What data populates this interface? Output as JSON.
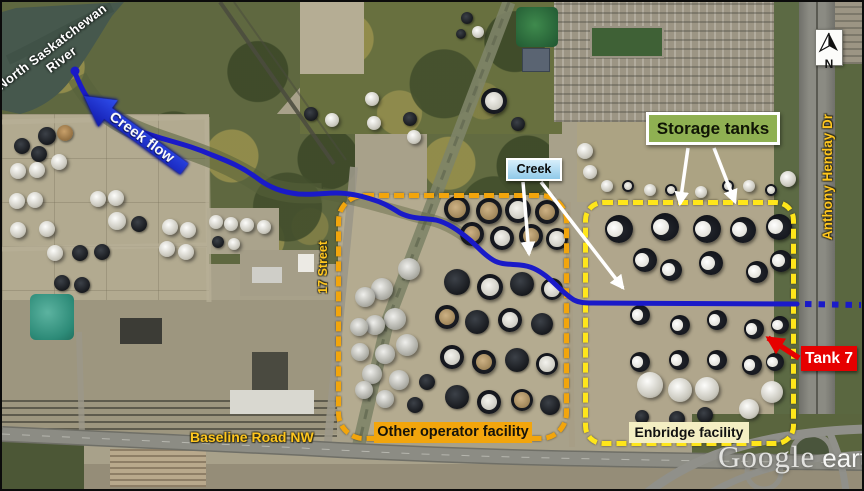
{
  "annotations": {
    "river": {
      "line1": "North Saskatchewan",
      "line2": "River"
    },
    "creek_flow": "Creek flow",
    "creek": "Creek",
    "storage_tanks": "Storage tanks",
    "street_17": "17 Street",
    "anthony_henday": "Anthony Henday Dr",
    "baseline_road": "Baseline Road NW",
    "other_facility": "Other operator facility",
    "enbridge_facility": "Enbridge facility",
    "tank7": "Tank 7",
    "north": "N"
  },
  "watermark": {
    "brand": "Google",
    "product": "earth"
  },
  "colors": {
    "creek": "#1a1ac8",
    "box-other": "#f2a50c",
    "box-enbridge": "#ffe61a",
    "road-label": "#ffc61e",
    "tank7-bg": "#e60000",
    "storage-bg": "#8fb052",
    "creek-label-top": "#d8effb",
    "creek-label-bottom": "#8fc9e9",
    "enbridge-label-bg": "#f4efc3"
  },
  "map_features": {
    "creek_path": "M73,71 C80,88 86,99 96,108 C108,119 122,123 140,130 C165,139 185,142 210,153 C228,160 240,165 255,176 C268,186 280,190 296,192 C312,193 322,191 334,191 C348,191 360,194 372,198 C382,201 390,206 398,211 C410,217 422,216 434,218 C446,221 456,228 468,238 C477,246 481,252 491,258 C499,263 509,262 518,263 C529,264 536,268 544,274 C553,281 561,291 572,298 C578,301 584,301 590,301 L795,302",
    "creek_outflow_dotted": "M803,302 L859,303",
    "tanks": [
      [
        45,
        134,
        9,
        "d"
      ],
      [
        63,
        131,
        8,
        "b"
      ],
      [
        20,
        144,
        8,
        "d"
      ],
      [
        37,
        152,
        8,
        "d"
      ],
      [
        57,
        160,
        8,
        "w"
      ],
      [
        16,
        169,
        8,
        "w"
      ],
      [
        35,
        168,
        8,
        "w"
      ],
      [
        15,
        199,
        8,
        "w"
      ],
      [
        33,
        198,
        8,
        "w"
      ],
      [
        96,
        197,
        8,
        "w"
      ],
      [
        114,
        196,
        8,
        "w"
      ],
      [
        16,
        228,
        8,
        "w"
      ],
      [
        45,
        227,
        8,
        "w"
      ],
      [
        115,
        219,
        9,
        "w"
      ],
      [
        137,
        222,
        8,
        "d"
      ],
      [
        168,
        225,
        8,
        "w"
      ],
      [
        186,
        228,
        8,
        "w"
      ],
      [
        165,
        247,
        8,
        "w"
      ],
      [
        184,
        250,
        8,
        "w"
      ],
      [
        53,
        251,
        8,
        "w"
      ],
      [
        78,
        251,
        8,
        "d"
      ],
      [
        60,
        281,
        8,
        "d"
      ],
      [
        80,
        283,
        8,
        "d"
      ],
      [
        100,
        250,
        8,
        "d"
      ],
      [
        214,
        220,
        7,
        "w"
      ],
      [
        229,
        222,
        7,
        "w"
      ],
      [
        245,
        223,
        7,
        "w"
      ],
      [
        262,
        225,
        7,
        "w"
      ],
      [
        216,
        240,
        6,
        "d"
      ],
      [
        232,
        242,
        6,
        "w"
      ],
      [
        370,
        97,
        7,
        "w"
      ],
      [
        372,
        121,
        7,
        "w"
      ],
      [
        309,
        112,
        7,
        "d"
      ],
      [
        330,
        118,
        7,
        "w"
      ],
      [
        412,
        135,
        7,
        "w"
      ],
      [
        408,
        117,
        7,
        "d"
      ],
      [
        465,
        16,
        6,
        "d"
      ],
      [
        476,
        30,
        6,
        "w"
      ],
      [
        459,
        32,
        5,
        "d"
      ],
      [
        492,
        99,
        13,
        "c"
      ],
      [
        516,
        122,
        7,
        "d"
      ],
      [
        583,
        149,
        8,
        "w"
      ],
      [
        588,
        170,
        7,
        "w"
      ],
      [
        605,
        184,
        6,
        "w"
      ],
      [
        626,
        184,
        6,
        "c"
      ],
      [
        648,
        188,
        6,
        "w"
      ],
      [
        669,
        188,
        6,
        "c"
      ],
      [
        699,
        190,
        6,
        "w"
      ],
      [
        726,
        184,
        6,
        "c"
      ],
      [
        747,
        184,
        6,
        "w"
      ],
      [
        769,
        188,
        6,
        "c"
      ],
      [
        786,
        177,
        8,
        "w"
      ],
      [
        617,
        227,
        14,
        "e"
      ],
      [
        663,
        225,
        14,
        "e"
      ],
      [
        705,
        227,
        14,
        "e"
      ],
      [
        741,
        228,
        13,
        "e"
      ],
      [
        777,
        225,
        13,
        "e"
      ],
      [
        643,
        258,
        12,
        "e"
      ],
      [
        669,
        268,
        11,
        "e"
      ],
      [
        709,
        261,
        12,
        "e"
      ],
      [
        755,
        270,
        11,
        "e"
      ],
      [
        779,
        259,
        11,
        "e"
      ],
      [
        638,
        313,
        10,
        "e"
      ],
      [
        678,
        323,
        10,
        "e"
      ],
      [
        715,
        318,
        10,
        "e"
      ],
      [
        752,
        327,
        10,
        "e"
      ],
      [
        778,
        323,
        9,
        "e"
      ],
      [
        638,
        360,
        10,
        "e"
      ],
      [
        677,
        358,
        10,
        "e"
      ],
      [
        715,
        358,
        10,
        "e"
      ],
      [
        750,
        363,
        10,
        "e"
      ],
      [
        773,
        360,
        9,
        "e"
      ],
      [
        648,
        383,
        13,
        "w"
      ],
      [
        678,
        388,
        12,
        "w"
      ],
      [
        705,
        387,
        12,
        "w"
      ],
      [
        770,
        390,
        11,
        "w"
      ],
      [
        747,
        407,
        10,
        "w"
      ],
      [
        675,
        417,
        8,
        "d"
      ],
      [
        703,
        413,
        8,
        "d"
      ],
      [
        640,
        415,
        7,
        "d"
      ],
      [
        455,
        207,
        13,
        "t"
      ],
      [
        487,
        209,
        13,
        "t"
      ],
      [
        516,
        208,
        13,
        "c"
      ],
      [
        545,
        210,
        12,
        "t"
      ],
      [
        470,
        232,
        12,
        "t"
      ],
      [
        500,
        236,
        12,
        "c"
      ],
      [
        529,
        234,
        12,
        "t"
      ],
      [
        555,
        237,
        11,
        "c"
      ],
      [
        455,
        280,
        13,
        "d"
      ],
      [
        488,
        285,
        13,
        "c"
      ],
      [
        520,
        282,
        12,
        "d"
      ],
      [
        550,
        287,
        11,
        "c"
      ],
      [
        445,
        315,
        12,
        "t"
      ],
      [
        475,
        320,
        12,
        "d"
      ],
      [
        508,
        318,
        12,
        "c"
      ],
      [
        540,
        322,
        11,
        "d"
      ],
      [
        450,
        355,
        12,
        "c"
      ],
      [
        482,
        360,
        12,
        "t"
      ],
      [
        515,
        358,
        12,
        "d"
      ],
      [
        545,
        362,
        11,
        "c"
      ],
      [
        455,
        395,
        12,
        "d"
      ],
      [
        487,
        400,
        12,
        "c"
      ],
      [
        520,
        398,
        11,
        "t"
      ],
      [
        548,
        403,
        10,
        "d"
      ],
      [
        407,
        267,
        11,
        "s"
      ],
      [
        380,
        287,
        11,
        "s"
      ],
      [
        363,
        295,
        10,
        "s"
      ],
      [
        393,
        317,
        11,
        "s"
      ],
      [
        373,
        323,
        10,
        "s"
      ],
      [
        357,
        325,
        9,
        "s"
      ],
      [
        405,
        343,
        11,
        "s"
      ],
      [
        383,
        352,
        10,
        "s"
      ],
      [
        358,
        350,
        9,
        "s"
      ],
      [
        370,
        372,
        10,
        "s"
      ],
      [
        397,
        378,
        10,
        "s"
      ],
      [
        362,
        388,
        9,
        "s"
      ],
      [
        383,
        397,
        9,
        "s"
      ],
      [
        413,
        403,
        8,
        "d"
      ],
      [
        425,
        380,
        8,
        "d"
      ]
    ]
  }
}
